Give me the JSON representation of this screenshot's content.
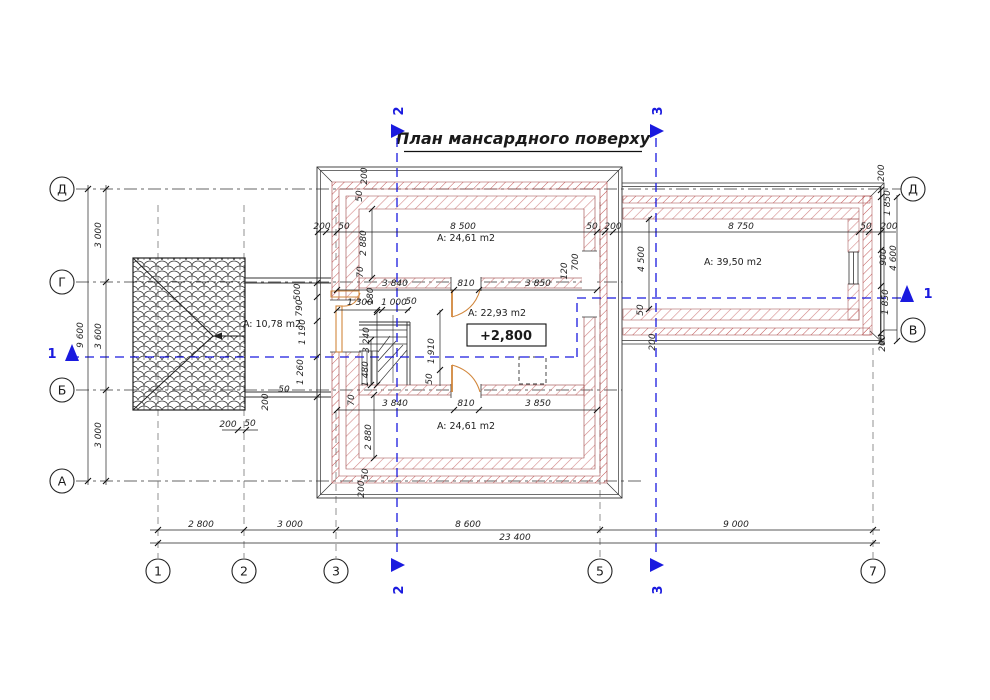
{
  "title": "План мансардного поверху",
  "axes": {
    "left": [
      "Д",
      "Г",
      "Б",
      "А"
    ],
    "right": [
      "Д",
      "В"
    ],
    "bottom": [
      "1",
      "2",
      "3",
      "5",
      "7"
    ]
  },
  "sections": {
    "s1": "1",
    "s2": "2",
    "s3": "3"
  },
  "rooms": {
    "balcony": "A: 10,78 m2",
    "top": "A: 24,61 m2",
    "middle": "A: 22,93 m2",
    "middle_elevation": "+2,800",
    "right": "A: 39,50 m2",
    "bottom": "A: 24,61 m2"
  },
  "dims": {
    "bottom": [
      "2 800",
      "3 000",
      "8 600",
      "9 000"
    ],
    "bottom_total": "23 400",
    "left": [
      "3 000",
      "3 600",
      "3 000"
    ],
    "left_total": "9 600",
    "top": [
      "200",
      "50",
      "8 500",
      "50",
      "200",
      "8 750",
      "50",
      "200"
    ],
    "top_left_vert": [
      "200",
      "50"
    ],
    "room_top_vert": [
      "2 880",
      "70"
    ],
    "wall1": [
      "3 840",
      "810",
      "3 850"
    ],
    "wall1_right_vert": [
      "120",
      "700"
    ],
    "wing_vert": [
      "4 500",
      "50",
      "200"
    ],
    "right_chain": [
      "200",
      "1 850",
      "900",
      "1 850",
      "200"
    ],
    "right_total": "4 600",
    "stair_top": [
      "1 300",
      "180",
      "1 000",
      "50"
    ],
    "stair_left_vert": [
      "3 240",
      "1 480",
      "70"
    ],
    "stair_right_vert": [
      "1 910",
      "50"
    ],
    "wall2": [
      "3 840",
      "810",
      "3 850"
    ],
    "room_bottom_vert": [
      "2 880",
      "50",
      "200"
    ],
    "balcony_vert": [
      "500",
      "790",
      "1 190",
      "1 260",
      "200",
      "50"
    ],
    "balcony_bottom": [
      "200",
      "50"
    ]
  },
  "colors": {
    "section_blue": "#1a1adf",
    "hatch_red": "#c25858",
    "hatch_pink": "#d38989",
    "door_orange": "#d2873c",
    "line": "#333333"
  }
}
